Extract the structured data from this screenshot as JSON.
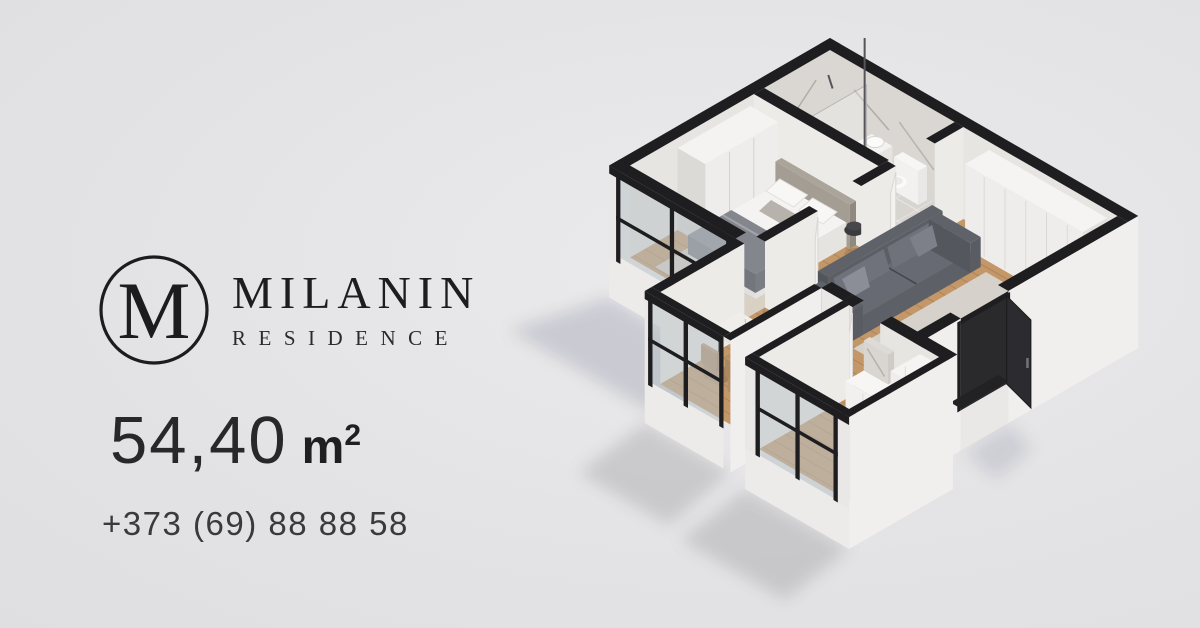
{
  "brand": {
    "monogram": "M",
    "name": "MILANIN",
    "subtitle": "RESIDENCE"
  },
  "listing": {
    "area_value": "54,40",
    "area_unit": "m",
    "area_sup": "2",
    "phone": "+373 (69) 88 88 58"
  },
  "colors": {
    "background": "#e3e3e5",
    "accent_tan": "#b28c69",
    "ink": "#1f1f21",
    "wall_cut_black": "#1e1e20",
    "wall_white": "#f0efed",
    "wood_floor": "#c39768",
    "sofa_grey": "#5c5e66"
  }
}
